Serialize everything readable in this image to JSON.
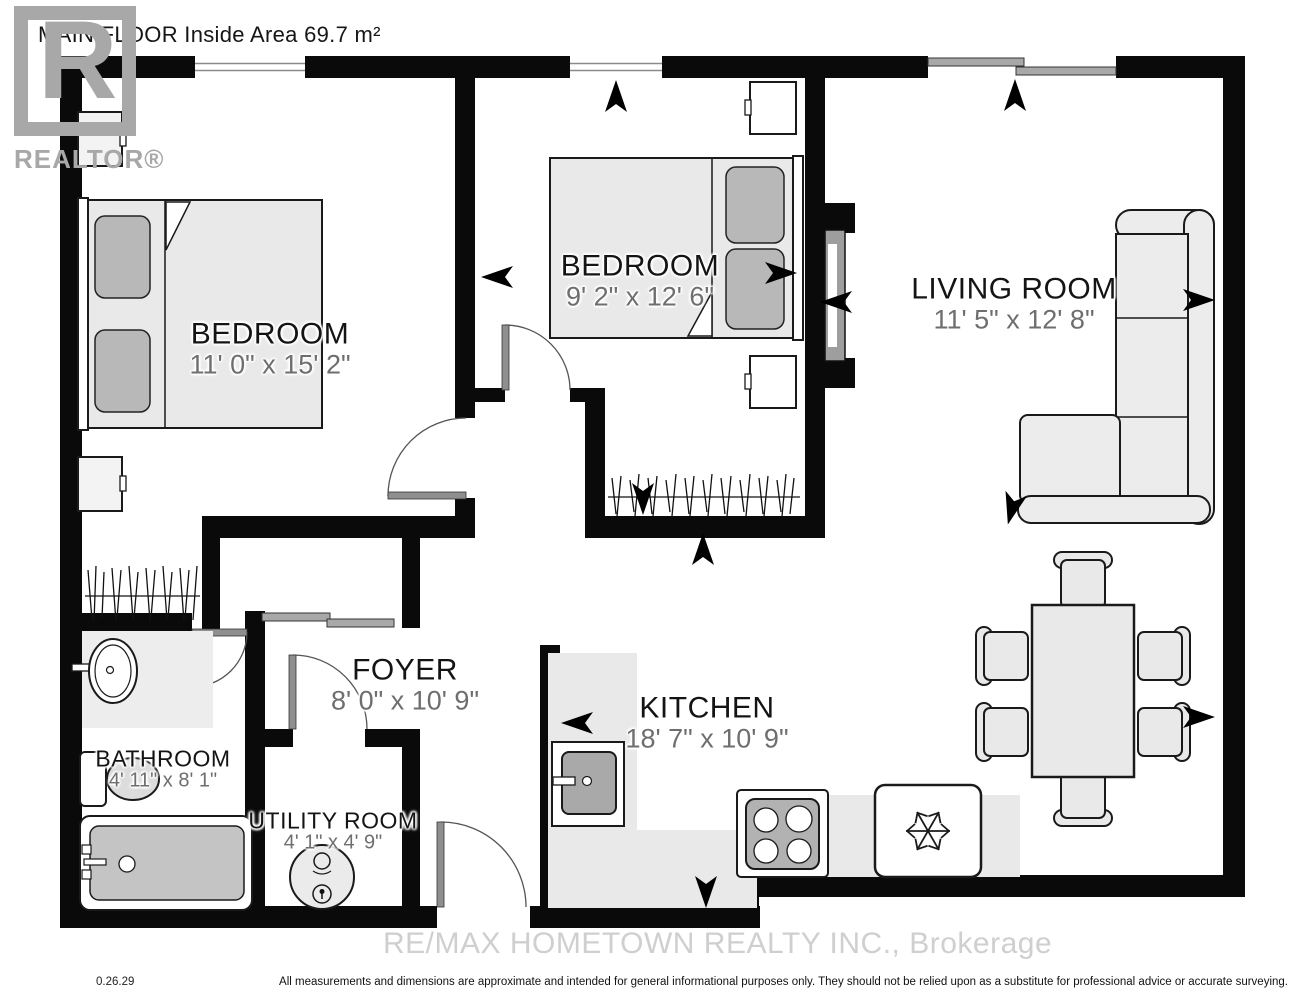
{
  "title": "MAIN FLOOR Inside Area 69.7 m²",
  "watermarks": {
    "logo_letter": "R",
    "logo_caption": "REALTOR®",
    "brokerage": "RE/MAX HOMETOWN REALTY INC., Brokerage"
  },
  "rooms": {
    "bedroom1": {
      "name": "BEDROOM",
      "dims": "11' 0\" x 15' 2\""
    },
    "bedroom2": {
      "name": "BEDROOM",
      "dims": "9' 2\" x 12' 6\""
    },
    "living": {
      "name": "LIVING ROOM",
      "dims": "11' 5\" x 12' 8\""
    },
    "foyer": {
      "name": "FOYER",
      "dims": "8' 0\" x 10' 9\""
    },
    "kitchen": {
      "name": "KITCHEN",
      "dims": "18' 7\" x 10' 9\""
    },
    "bathroom": {
      "name": "BATHROOM",
      "dims": "4' 11\" x 8' 1\""
    },
    "utility": {
      "name": "UTILITY ROOM",
      "dims": "4' 1\" x 4' 9\""
    }
  },
  "footer": {
    "revision": "0.26.29",
    "disclaimer": "All measurements and dimensions are approximate and intended for general informational purposes only. They should not be relied upon as a substitute for professional advice or accurate surveying."
  },
  "colors": {
    "wall": "#0a0a0a",
    "furniture_fill": "#e9e9e9",
    "furniture_dark": "#b8b8b8",
    "outline": "#1a1a1a",
    "dim_text": "#6e6e6e",
    "watermark_gray": "#a8a8a8"
  }
}
